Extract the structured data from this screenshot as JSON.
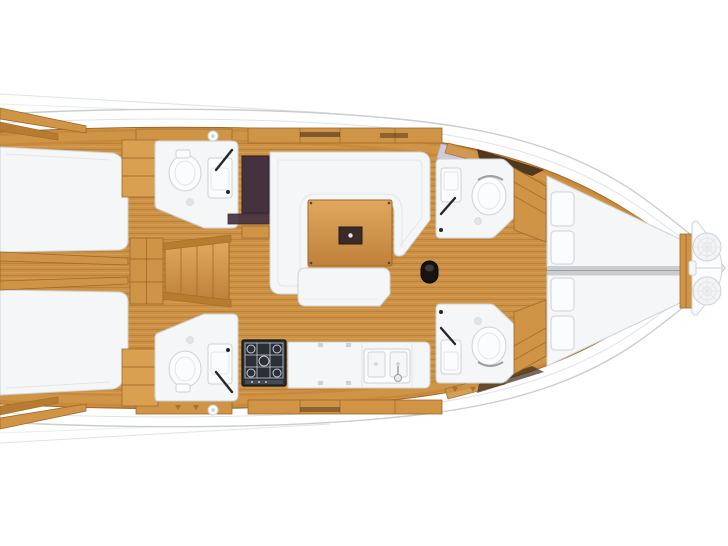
{
  "diagram": {
    "kind": "sailing-yacht-interior-floor-plan",
    "orientation": {
      "bow": "right",
      "stern": "left (cropped at image edge)",
      "port_side": "top",
      "starboard_side": "bottom"
    },
    "regions": [
      {
        "id": "aft-cabin-port",
        "label": "Aft double cabin (port, top-left)"
      },
      {
        "id": "aft-cabin-starboard",
        "label": "Aft double cabin (starboard, bottom-left)"
      },
      {
        "id": "head-aft-port",
        "label": "Aft head with toilet + sink (top-left)"
      },
      {
        "id": "head-aft-starboard",
        "label": "Aft head with toilet + sink (bottom-left)"
      },
      {
        "id": "companionway",
        "label": "Companionway steps amidships-left"
      },
      {
        "id": "salon",
        "label": "Salon with U-shaped settee and wood table"
      },
      {
        "id": "settee-bench",
        "label": "Straight settee bench below table"
      },
      {
        "id": "galley",
        "label": "Galley with stove and double sink (bottom-center)"
      },
      {
        "id": "mast-step",
        "label": "Mast step (dark fitting right of salon)"
      },
      {
        "id": "head-forward-port",
        "label": "Forward head with sink + toilet (top-right)"
      },
      {
        "id": "head-forward-starboard",
        "label": "Forward head with sink + toilet (bottom-right)"
      },
      {
        "id": "forward-cabin",
        "label": "Forward cabin, twin berths with pillows"
      },
      {
        "id": "anchor-locker",
        "label": "Bow anchor locker with two rope coils"
      }
    ],
    "fixtures": [
      "toilet-icon",
      "sink-icon",
      "shower-drain-icon",
      "stove-icon",
      "double-sink-icon",
      "dinette-table-icon",
      "companionway-steps-icon",
      "mast-step-icon",
      "pillow-icon",
      "rope-coil-icon",
      "porthole-icon",
      "deck-hatch-icon"
    ]
  },
  "colors": {
    "background": "#ffffff",
    "hull_outline": "#c8cdd0",
    "deck_line": "#dfe3e6",
    "wood_floor": "#cd9145",
    "plank_dark": "#ab7531",
    "plank_light": "#e0a75c",
    "wood_band": "#c8893a",
    "wood_mid": "#cf9446",
    "wood_light2": "#d9a052",
    "wood_rail": "#b77c30",
    "wood_edge": "#9d6828",
    "fixture": "#f5f6f8",
    "fixture_bright": "#fbfcfd",
    "fixture_outline": "#cdd2d6",
    "fixture_inner": "#e2e5e8",
    "berth_gap": "#c9cdd0",
    "wardrobe": "#46323f",
    "wardrobe_edge": "#2f2130",
    "stove": "#2a2e36",
    "stove_edge": "#121418",
    "stove_grid": "#c8cdd2",
    "table_leaf": "#3a2b28",
    "mast": "#17130e",
    "hatch_lilac": "#cfcbdd",
    "shadow_dark": "#3b2817",
    "metal_dark": "#24262a"
  }
}
